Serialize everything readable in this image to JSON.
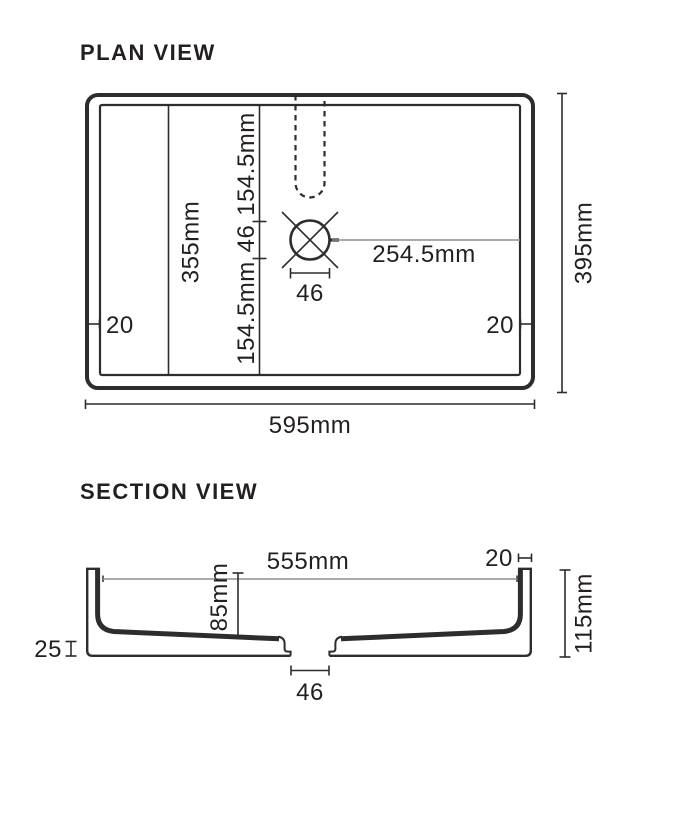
{
  "colors": {
    "line": "#2e2d2c",
    "thin_line": "#8d8d8d",
    "text": "#231f20",
    "background": "#ffffff"
  },
  "plan_view": {
    "title": "PLAN VIEW",
    "overall_length": "595mm",
    "overall_width": "395mm",
    "inner_width": "355mm",
    "upper_offset": "154.5mm",
    "hole_diameter": "46",
    "lower_offset": "154.5mm",
    "hole_to_wall": "254.5mm",
    "hole_width": "46",
    "wall_thickness_left": "20",
    "wall_thickness_right": "20"
  },
  "section_view": {
    "title": "SECTION VIEW",
    "inner_width": "555mm",
    "rim_thickness": "20",
    "bowl_depth": "85mm",
    "overall_height": "115mm",
    "base_height": "25",
    "drain_width": "46"
  }
}
